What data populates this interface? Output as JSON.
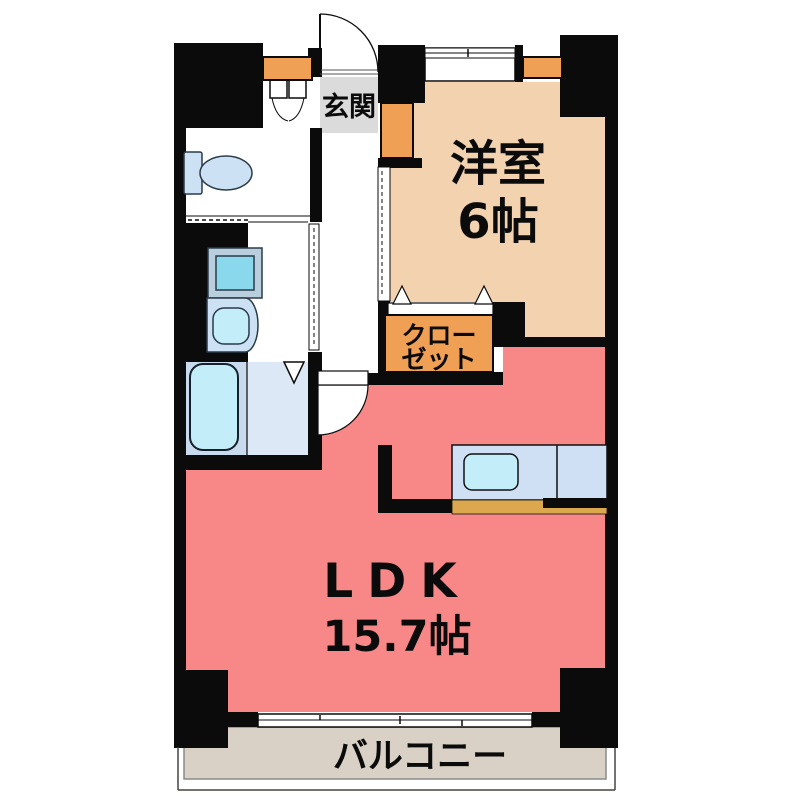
{
  "plan": {
    "type": "floorplan",
    "title": "1LDK apartment floor plan",
    "rooms": [
      {
        "id": "genkan",
        "label": "玄関"
      },
      {
        "id": "yoshitsu",
        "label": "洋室",
        "size": "6帖"
      },
      {
        "id": "closet",
        "label_line1": "クロー",
        "label_line2": "ゼット"
      },
      {
        "id": "ldk",
        "label": "LDK",
        "size": "15.7帖"
      },
      {
        "id": "balcony",
        "label": "バルコニー"
      },
      {
        "id": "bathroom"
      },
      {
        "id": "washroom"
      },
      {
        "id": "toilet_room"
      }
    ],
    "fixtures": [
      "toilet",
      "washing-machine",
      "washbasin",
      "bathtub",
      "kitchen-counter",
      "kitchen-sink",
      "shoe-cabinet",
      "closet-cabinet",
      "storage-shelf"
    ],
    "doors": [
      "entrance-swing-door",
      "hallway-to-ldk-swing-door",
      "bifold-door-toilet-nook",
      "sliding-door-washroom",
      "sliding-door-yoshitsu",
      "closet-folding-door",
      "bathroom-door",
      "balcony-sliding-window",
      "yoshitsu-window"
    ]
  },
  "colors": {
    "wall": "#0b0b0b",
    "yoshitsu": "#f3d2b0",
    "ldk": "#f88ا888",
    "ldk_fill": "#f88888",
    "balcony": "#d9d1c6",
    "genkan": "#dbdbdb",
    "orange": "#f0a055",
    "counter_tan": "#dba84e",
    "bath_floor": "#dce8f6",
    "tub_zone": "#c8daee",
    "fixture_blue": "#cde1f5",
    "cyan": "#c3edf8",
    "counter_blue": "#cfe0f5",
    "wm_frame": "#b9cfde",
    "wm_drum": "#8ad8ec",
    "text": "#0b0b0b"
  }
}
